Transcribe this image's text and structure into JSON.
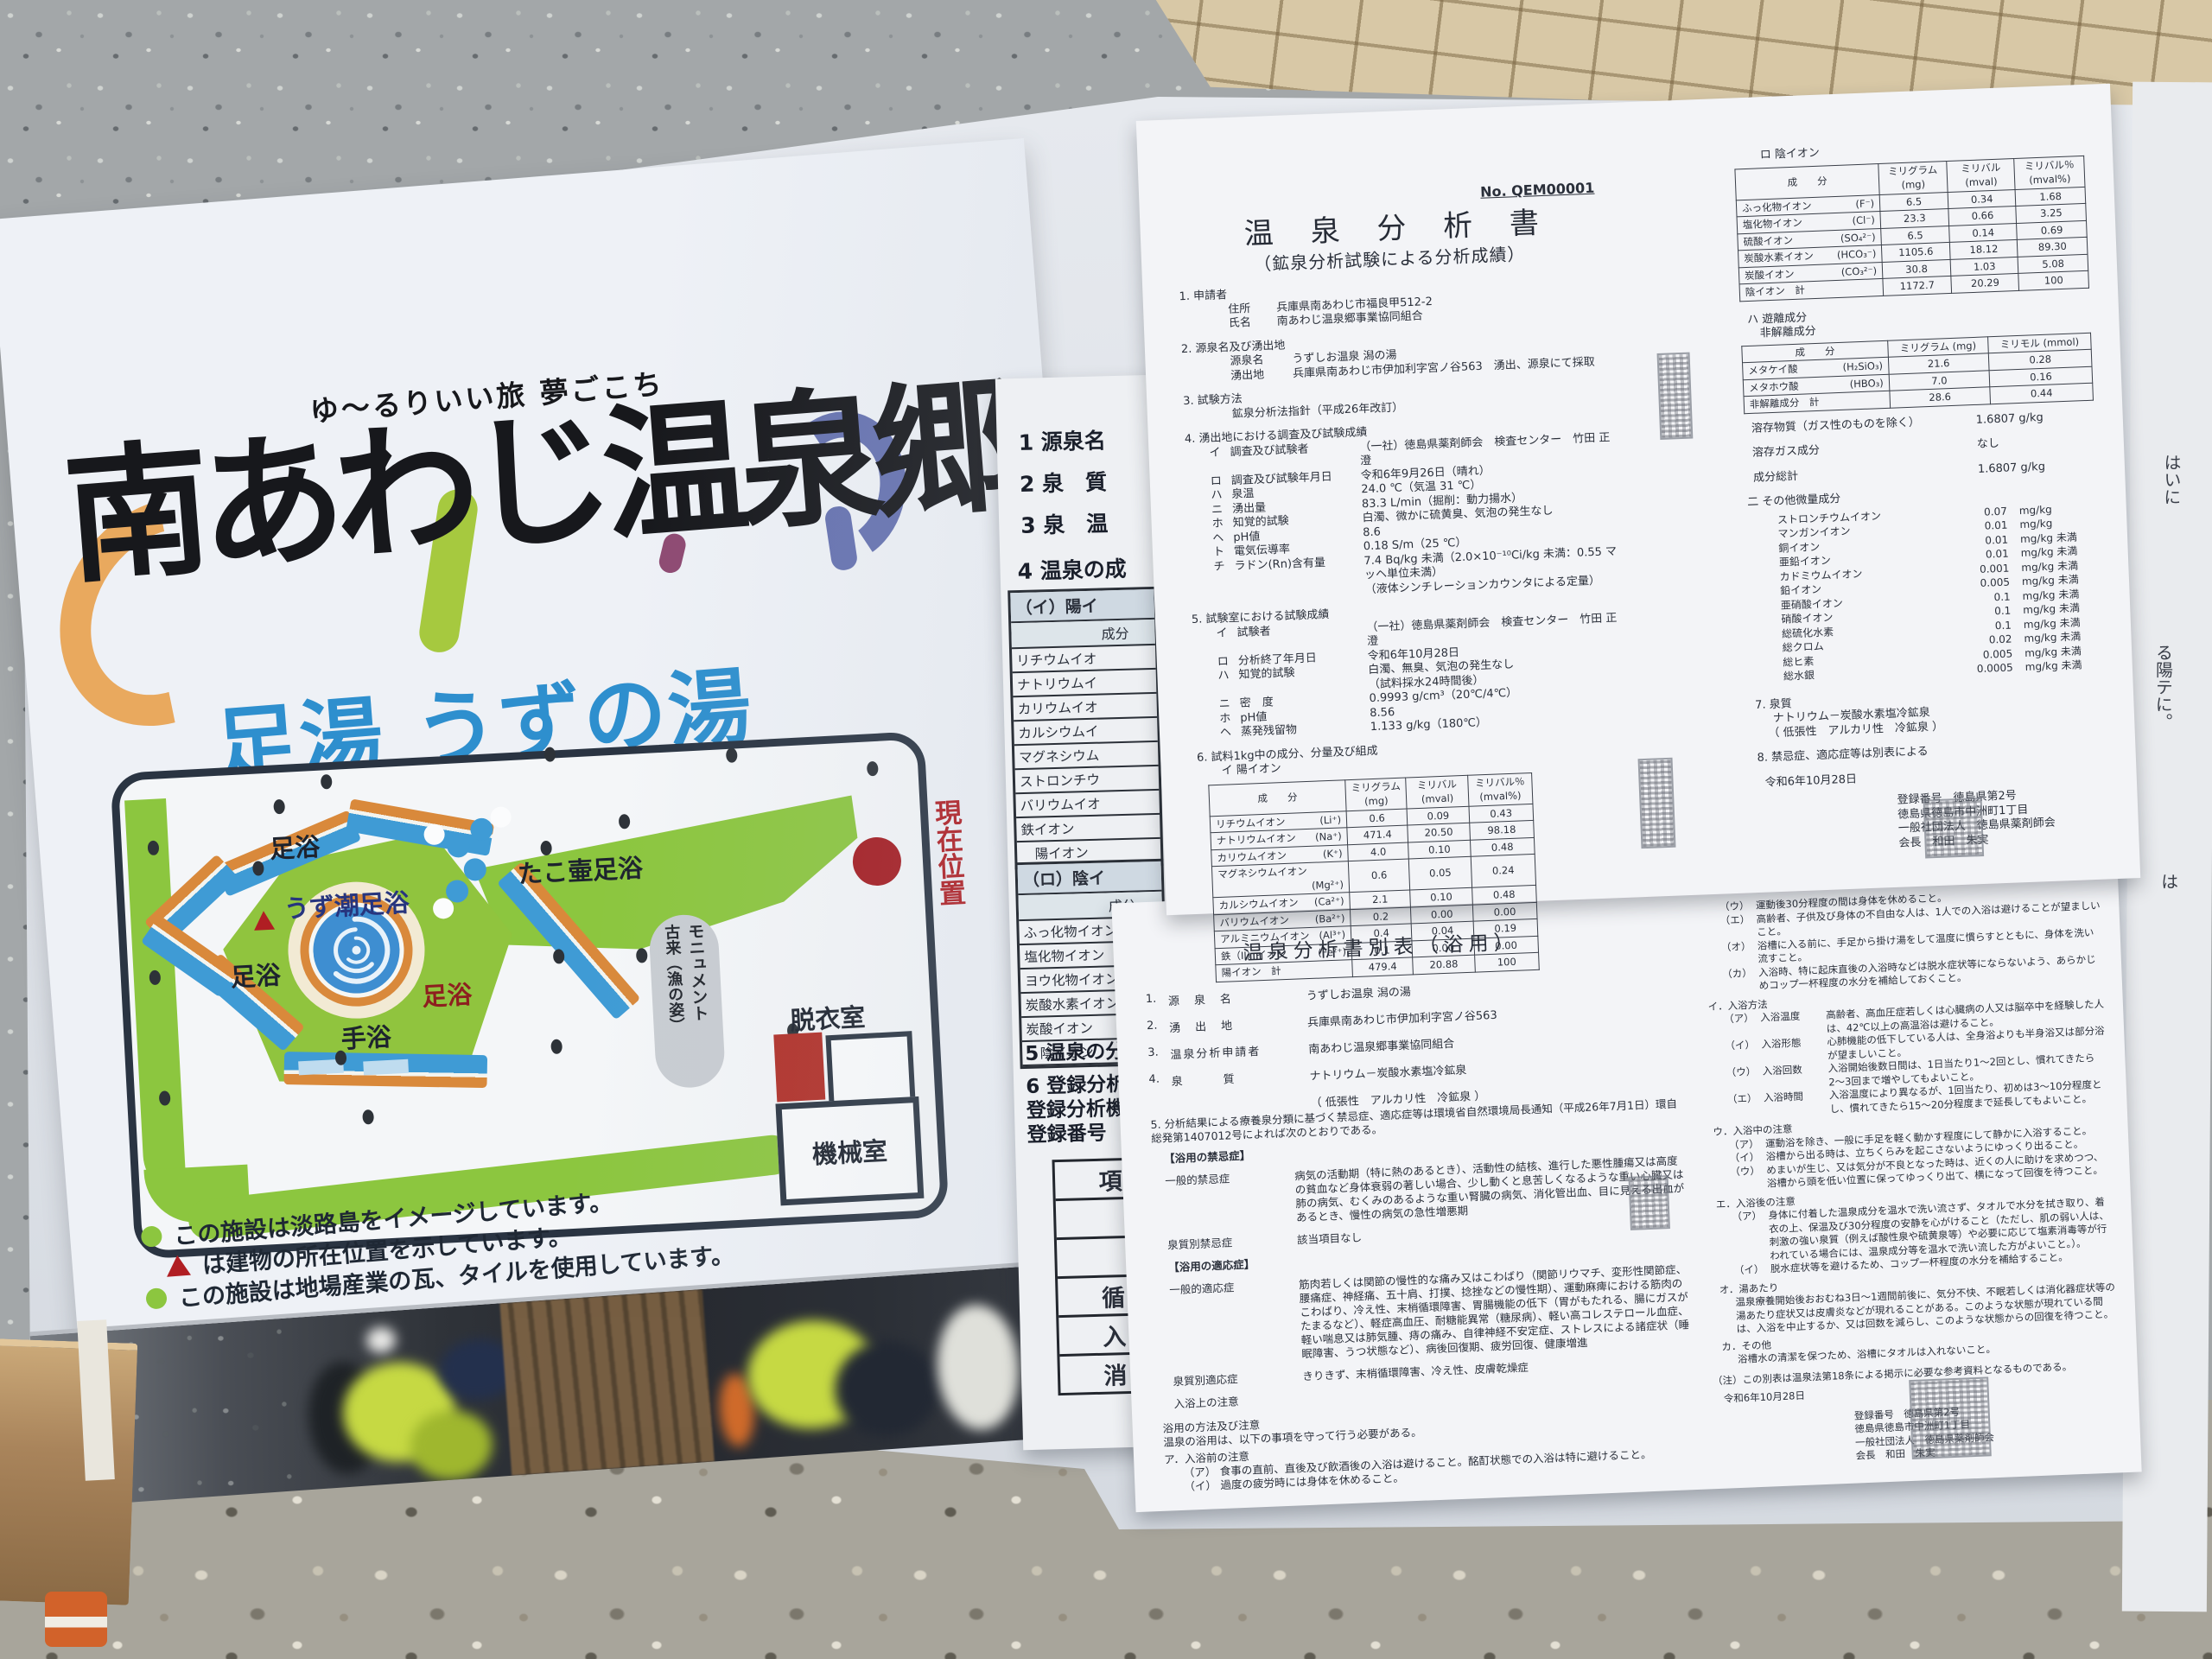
{
  "sign": {
    "tagline": "ゆ〜るりいい旅 夢ごこち",
    "logo_text": "南あわじ温泉郷",
    "title": "足湯 うずの湯",
    "map": {
      "labels": {
        "footbath_top": "足浴",
        "uzushio_footbath": "うず潮足浴",
        "takotsubo_footbath": "たこ壷足浴",
        "footbath_left": "足浴",
        "footbath_right": "足浴",
        "hand_bath": "手浴",
        "current_location": "現在位置",
        "monument_line1": "モニュメント",
        "monument_line2": "古来（漁の姿）",
        "dressing_room": "脱衣室",
        "machine_room": "機械室"
      }
    },
    "legend": [
      {
        "marker": "green-dot",
        "text": "この施設は淡路島をイメージしています。"
      },
      {
        "marker": "red-triangle",
        "text": "は建物の所在位置を示しています。"
      },
      {
        "marker": "green-dot",
        "text": "この施設は地場産業の瓦、タイルを使用しています。"
      }
    ],
    "colors": {
      "accent_blue": "#2e8fce",
      "logo_orange": "#e9a95e",
      "logo_green": "#a6c93f",
      "logo_purple": "#8e4a72",
      "logo_violet": "#6672b0",
      "map_green": "#8cc63f",
      "path_blue": "#3f9bd5",
      "path_orange": "#d9893b",
      "marker_red": "#b01e23"
    }
  },
  "doc1": {
    "doc_no": "No. QEM00001",
    "title": "温 泉 分 析 書",
    "subtitle": "（鉱泉分析試験による分析成績）",
    "s1_head": "1. 申請者",
    "s1_lines": [
      {
        "label": "住所",
        "text": "兵庫県南あわじ市福良甲512-2"
      },
      {
        "label": "氏名",
        "text": "南あわじ温泉郷事業協同組合"
      }
    ],
    "s2_head": "2. 源泉名及び湧出地",
    "s2_lines": [
      {
        "label": "源泉名",
        "text": "うずしお温泉 潟の湯"
      },
      {
        "label": "湧出地",
        "text": "兵庫県南あわじ市伊加利字宮ノ谷563　湧出、源泉にて採取"
      }
    ],
    "s3_head": "3. 試験方法",
    "s3_lines": [
      {
        "label": "",
        "text": "鉱泉分析法指針（平成26年改訂）"
      }
    ],
    "s4_head": "4. 湧出地における調査及び試験成績",
    "s4_items": [
      {
        "k": "イ",
        "label": "調査及び試験者",
        "text": "（一社）徳島県薬剤師会　検査センター　竹田 正澄"
      },
      {
        "k": "ロ",
        "label": "調査及び試験年月日",
        "text": "令和6年9月26日（晴れ）"
      },
      {
        "k": "ハ",
        "label": "泉温",
        "text": "24.0 ℃（気温 31 ℃）"
      },
      {
        "k": "ニ",
        "label": "湧出量",
        "text": "83.3 L/min（掘削：動力揚水）"
      },
      {
        "k": "ホ",
        "label": "知覚的試験",
        "text": "白濁、微かに硫黄臭、気泡の発生なし"
      },
      {
        "k": "ヘ",
        "label": "pH値",
        "text": "8.6"
      },
      {
        "k": "ト",
        "label": "電気伝導率",
        "text": "0.18 S/m（25 ℃）"
      },
      {
        "k": "チ",
        "label": "ラドン(Rn)含有量",
        "text": "7.4 Bq/kg 未満（2.0×10⁻¹⁰Ci/kg 未満：0.55 マッヘ単位未満）"
      },
      {
        "k": "",
        "label": "",
        "text": "（液体シンチレーションカウンタによる定量）"
      }
    ],
    "s5_head": "5. 試験室における試験成績",
    "s5_items": [
      {
        "k": "イ",
        "label": "試験者",
        "text": "（一社）徳島県薬剤師会　検査センター　竹田 正澄"
      },
      {
        "k": "ロ",
        "label": "分析終了年月日",
        "text": "令和6年10月28日"
      },
      {
        "k": "ハ",
        "label": "知覚的試験",
        "text": "白濁、無臭、気泡の発生なし"
      },
      {
        "k": "",
        "label": "",
        "text": "（試料採水24時間後）"
      },
      {
        "k": "ニ",
        "label": "密　度",
        "text": "0.9993 g/cm³（20℃/4℃）"
      },
      {
        "k": "ホ",
        "label": "pH値",
        "text": "8.56"
      },
      {
        "k": "ヘ",
        "label": "蒸発残留物",
        "text": "1.133 g/kg（180℃）"
      }
    ],
    "s6_head": "6. 試料1kg中の成分、分量及び組成",
    "cation_head": "イ 陽イオン",
    "anion_head": "ロ 陰イオン",
    "table_headers": {
      "component": "成　　分",
      "mg": "ミリグラム",
      "mg_unit": "(mg)",
      "mval": "ミリバル",
      "mval_unit": "(mval)",
      "mval_pct": "ミリバル％",
      "mval_pct_unit": "(mval%)"
    },
    "cation_rows": [
      [
        "リチウムイオン",
        "(Li⁺)",
        "0.6",
        "0.09",
        "0.43"
      ],
      [
        "ナトリウムイオン",
        "(Na⁺)",
        "471.4",
        "20.50",
        "98.18"
      ],
      [
        "カリウムイオン",
        "(K⁺)",
        "4.0",
        "0.10",
        "0.48"
      ],
      [
        "マグネシウムイオン",
        "(Mg²⁺)",
        "0.6",
        "0.05",
        "0.24"
      ],
      [
        "カルシウムイオン",
        "(Ca²⁺)",
        "2.1",
        "0.10",
        "0.48"
      ],
      [
        "バリウムイオン",
        "(Ba²⁺)",
        "0.2",
        "0.00",
        "0.00"
      ],
      [
        "アルミニウムイオン",
        "(Al³⁺)",
        "0.4",
        "0.04",
        "0.19"
      ],
      [
        "鉄（II）イオン",
        "(Fe²⁺)",
        "0.1",
        "0.00",
        "0.00"
      ],
      [
        "陽イオン　計",
        "",
        "479.4",
        "20.88",
        "100"
      ]
    ],
    "anion_rows": [
      [
        "ふっ化物イオン",
        "(F⁻)",
        "6.5",
        "0.34",
        "1.68"
      ],
      [
        "塩化物イオン",
        "(Cl⁻)",
        "23.3",
        "0.66",
        "3.25"
      ],
      [
        "硫酸イオン",
        "(SO₄²⁻)",
        "6.5",
        "0.14",
        "0.69"
      ],
      [
        "炭酸水素イオン",
        "(HCO₃⁻)",
        "1105.6",
        "18.12",
        "89.30"
      ],
      [
        "炭酸イオン",
        "(CO₃²⁻)",
        "30.8",
        "1.03",
        "5.08"
      ],
      [
        "陰イオン　計",
        "",
        "1172.7",
        "20.29",
        "100"
      ]
    ],
    "free_head": "ハ 遊離成分",
    "free_sub": "非解離成分",
    "free_headers": {
      "component": "成　　分",
      "mg": "ミリグラム (mg)",
      "mmol": "ミリモル (mmol)"
    },
    "free_rows": [
      [
        "メタケイ酸",
        "(H₂SiO₃)",
        "21.6",
        "0.28"
      ],
      [
        "メタホウ酸",
        "(HBO₃)",
        "7.0",
        "0.16"
      ],
      [
        "非解離成分　計",
        "",
        "28.6",
        "0.44"
      ]
    ],
    "dissolved_label": "溶存物質（ガス性のものを除く）",
    "dissolved_value": "1.6807 g/kg",
    "gas_label": "溶存ガス成分",
    "gas_value": "なし",
    "total_label": "成分総計",
    "total_value": "1.6807 g/kg",
    "trace_head": "二 その他微量成分",
    "trace_rows": [
      [
        "ストロンチウムイオン",
        "0.07",
        "mg/kg"
      ],
      [
        "マンガンイオン",
        "0.01",
        "mg/kg"
      ],
      [
        "銅イオン",
        "0.01",
        "mg/kg 未満"
      ],
      [
        "亜鉛イオン",
        "0.01",
        "mg/kg 未満"
      ],
      [
        "カドミウムイオン",
        "0.001",
        "mg/kg 未満"
      ],
      [
        "鉛イオン",
        "0.005",
        "mg/kg 未満"
      ],
      [
        "亜硝酸イオン",
        "0.1",
        "mg/kg 未満"
      ],
      [
        "硝酸イオン",
        "0.1",
        "mg/kg 未満"
      ],
      [
        "総硫化水素",
        "0.1",
        "mg/kg 未満"
      ],
      [
        "総クロム",
        "0.02",
        "mg/kg 未満"
      ],
      [
        "総ヒ素",
        "0.005",
        "mg/kg 未満"
      ],
      [
        "総水銀",
        "0.0005",
        "mg/kg 未満"
      ]
    ],
    "s7_head": "7. 泉質",
    "s7_line1": "ナトリウム－炭酸水素塩冷鉱泉",
    "s7_line2": "（ 低張性　アルカリ性　冷鉱泉 ）",
    "s8_head": "8. 禁忌症、適応症等は別表による",
    "date": "令和6年10月28日",
    "reg_no": "登録番号　徳島県第2号",
    "reg_addr": "徳島県徳島市中洲町1丁目",
    "reg_org": "一般社団法人　徳島県薬剤師会",
    "reg_head": "会長　和田　朱実"
  },
  "doc2": {
    "title": "温泉分析書別表（浴用）",
    "items": [
      {
        "no": "1.",
        "label": "源　泉　名",
        "text": "うずしお温泉 潟の湯"
      },
      {
        "no": "2.",
        "label": "湧　出　地",
        "text": "兵庫県南あわじ市伊加利字宮ノ谷563"
      },
      {
        "no": "3.",
        "label": "温泉分析申請者",
        "text": "南あわじ温泉郷事業協同組合"
      },
      {
        "no": "4.",
        "label": "泉　　　質",
        "text": "ナトリウム－炭酸水素塩冷鉱泉"
      },
      {
        "no": "",
        "label": "",
        "text": "（ 低張性　アルカリ性　冷鉱泉 ）"
      }
    ],
    "s5_text": "5. 分析結果による療養泉分類に基づく禁忌症、適応症等は環境省自然環境局長通知（平成26年7月1日）環自総発第1407012号によれば次のとおりである。",
    "kinki_head": "【浴用の禁忌症】",
    "kinki_general_label": "一般的禁忌症",
    "kinki_general_text": "病気の活動期（特に熱のあるとき）、活動性の結核、進行した悪性腫瘍又は高度の貧血など身体衰弱の著しい場合、少し動くと息苦しくなるような重い心臓又は肺の病気、むくみのあるような重い腎臓の病気、消化管出血、目に見える出血があるとき、慢性の病気の急性増悪期",
    "kinki_type_label": "泉質別禁忌症",
    "kinki_type_text": "該当項目なし",
    "tekio_head": "【浴用の適応症】",
    "tekio_general_label": "一般的適応症",
    "tekio_general_text": "筋肉若しくは関節の慢性的な痛み又はこわばり（関節リウマチ、変形性関節症、腰痛症、神経痛、五十肩、打撲、捻挫などの慢性期）、運動麻痺における筋肉のこわばり、冷え性、末梢循環障害、胃腸機能の低下（胃がもたれる、腸にガスがたまるなど）、軽症高血圧、耐糖能異常（糖尿病）、軽い高コレステロール血症、軽い喘息又は肺気腫、痔の痛み、自律神経不安定症、ストレスによる諸症状（睡眠障害、うつ状態など）、病後回復期、疲労回復、健康増進",
    "tekio_type_label": "泉質別適応症",
    "tekio_type_text": "きりきず、末梢循環障害、冷え性、皮膚乾燥症",
    "nyuyoku_note_label": "入浴上の注意",
    "method_head": "浴用の方法及び注意",
    "method_intro": "温泉の浴用は、以下の事項を守って行う必要がある。",
    "a_head": "ア．入浴前の注意",
    "a_items_left": [
      {
        "k": "（ア）",
        "text": "食事の直前、直後及び飲酒後の入浴は避けること。酩酊状態での入浴は特に避けること。"
      },
      {
        "k": "（イ）",
        "text": "過度の疲労時には身体を休めること。"
      }
    ],
    "a_items_right": [
      {
        "k": "（ウ）",
        "text": "運動後30分程度の間は身体を休めること。"
      },
      {
        "k": "（エ）",
        "text": "高齢者、子供及び身体の不自由な人は、1人での入浴は避けることが望ましいこと。"
      },
      {
        "k": "（オ）",
        "text": "浴槽に入る前に、手足から掛け湯をして温度に慣らすとともに、身体を洗い流すこと。"
      },
      {
        "k": "（カ）",
        "text": "入浴時、特に起床直後の入浴時などは脱水症状等にならないよう、あらかじめコップ一杯程度の水分を補給しておくこと。"
      }
    ],
    "i_head": "イ．入浴方法",
    "i_items": [
      {
        "k": "（ア）",
        "label": "入浴温度",
        "text": "高齢者、高血圧症若しくは心臓病の人又は脳卒中を経験した人は、42℃以上の高温浴は避けること。"
      },
      {
        "k": "（イ）",
        "label": "入浴形態",
        "text": "心肺機能の低下している人は、全身浴よりも半身浴又は部分浴が望ましいこと。"
      },
      {
        "k": "（ウ）",
        "label": "入浴回数",
        "text": "入浴開始後数日間は、1日当たり1〜2回とし、慣れてきたら2〜3回まで増やしてもよいこと。"
      },
      {
        "k": "（エ）",
        "label": "入浴時間",
        "text": "入浴温度により異なるが、1回当たり、初めは3〜10分程度とし、慣れてきたら15〜20分程度まで延長してもよいこと。"
      }
    ],
    "u_head": "ウ．入浴中の注意",
    "u_items": [
      {
        "k": "（ア）",
        "text": "運動浴を除き、一般に手足を軽く動かす程度にして静かに入浴すること。"
      },
      {
        "k": "（イ）",
        "text": "浴槽から出る時は、立ちくらみを起こさないようにゆっくり出ること。"
      },
      {
        "k": "（ウ）",
        "text": "めまいが生じ、又は気分が不良となった時は、近くの人に助けを求めつつ、浴槽から頭を低い位置に保ってゆっくり出て、横になって回復を待つこと。"
      }
    ],
    "e_head": "エ．入浴後の注意",
    "e_items": [
      {
        "k": "（ア）",
        "text": "身体に付着した温泉成分を温水で洗い流さず、タオルで水分を拭き取り、着衣の上、保温及び30分程度の安静を心がけること（ただし、肌の弱い人は、刺激の強い泉質（例えば酸性泉や硫黄泉等）や必要に応じて塩素消毒等が行われている場合には、温泉成分等を温水で洗い流した方がよいこと。）。"
      },
      {
        "k": "（イ）",
        "text": "脱水症状等を避けるため、コップ一杯程度の水分を補給すること。"
      }
    ],
    "o_head": "オ．湯あたり",
    "o_text": "温泉療養開始後おおむね3日〜1週間前後に、気分不快、不眠若しくは消化器症状等の湯あたり症状又は皮膚炎などが現れることがある。このような状態が現れている間は、入浴を中止するか、又は回数を減らし、このような状態からの回復を待つこと。",
    "ka_head": "カ．その他",
    "ka_text": "浴槽水の清潔を保つため、浴槽にタオルは入れないこと。",
    "note_text": "（注）この別表は温泉法第18条による掲示に必要な参考資料となるものである。",
    "date": "令和6年10月28日",
    "reg_no": "登録番号　徳島県第2号",
    "reg_addr": "徳島県徳島市中洲町1丁目",
    "reg_org": "一般社団法人　徳島県薬剤師会",
    "reg_head": "会長　和田　朱実"
  },
  "underlay": {
    "lines": [
      "1 源泉名",
      "2 泉　質",
      "3 泉　温",
      "4 温泉の成"
    ],
    "cation_header": "（イ）陽イ",
    "col_header": "成分",
    "cation_rows": [
      "リチウムイオ",
      "ナトリウムイ",
      "カリウムイオ",
      "カルシウムイ",
      "マグネシウム",
      "ストロンチウ",
      "バリウムイオ",
      "鉄イオン",
      "　陽イオン"
    ],
    "anion_header": "（ロ）陰イ",
    "anion_rows": [
      "ふっ化物イオン",
      "塩化物イオン",
      "ヨウ化物イオン",
      "炭酸水素イオン",
      "炭酸イオン",
      "　陰イオン"
    ],
    "bottom_lines": [
      "5 温泉の分析",
      "6 登録分析機",
      "登録分析機",
      "登録番号"
    ],
    "grid_cells": [
      "項",
      "",
      "",
      "循",
      "入",
      "消"
    ]
  },
  "edge_fragments": [
    "はいに",
    "る陽テに。",
    "は"
  ]
}
